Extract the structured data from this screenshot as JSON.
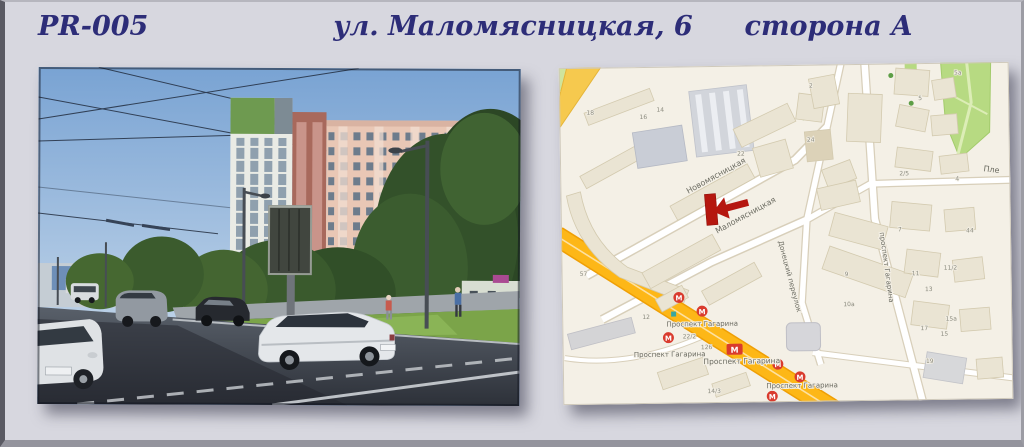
{
  "page": {
    "background": "#d7d7df",
    "frame_color": "#5a5a63",
    "header_text_color": "#2d2d78"
  },
  "header": {
    "code": "PR-005",
    "address": "ул. Маломясницкая, 6",
    "side": "сторона А"
  },
  "photo": {
    "colors": {
      "sky": "#7ea6d4",
      "building_pink": "#e9c7b5",
      "trees": "#33512a",
      "road": "#3a414b",
      "grass": "#7ba449"
    }
  },
  "map": {
    "streets": {
      "novomyasnitskaya": "Новомясницкая",
      "malomyasnitskaya": "Маломясницкая",
      "donetsky_lane": "Донецкий переулок",
      "gagarina_street": "проспект Гагарина",
      "edge_partial": "Пле"
    },
    "labels": {
      "metro_station_red": "Проспект Гагарина",
      "avenue_gray_1": "Проспект Гагарина",
      "avenue_gray_2": "Проспект Гагарина",
      "avenue_gray_3": "Проспект Гагарина"
    },
    "metro_letter": "М",
    "numbers": [
      "18",
      "16",
      "14",
      "22",
      "2",
      "24",
      "57",
      "44",
      "7",
      "11",
      "11/2",
      "13",
      "15а",
      "15",
      "17",
      "19",
      "2/5",
      "4",
      "5а",
      "5",
      "9",
      "10а",
      "126",
      "22/2",
      "14/3",
      "12"
    ],
    "colors": {
      "land": "#f4f0e6",
      "building": "#eae4d3",
      "green": "#b7da82",
      "highway_orange": "#fdb717",
      "street_white": "#ffffff",
      "marker_red": "#b5170f",
      "metro_red": "#d93b2e",
      "label_red": "#e03428",
      "label_gray": "#6c6c62"
    }
  }
}
